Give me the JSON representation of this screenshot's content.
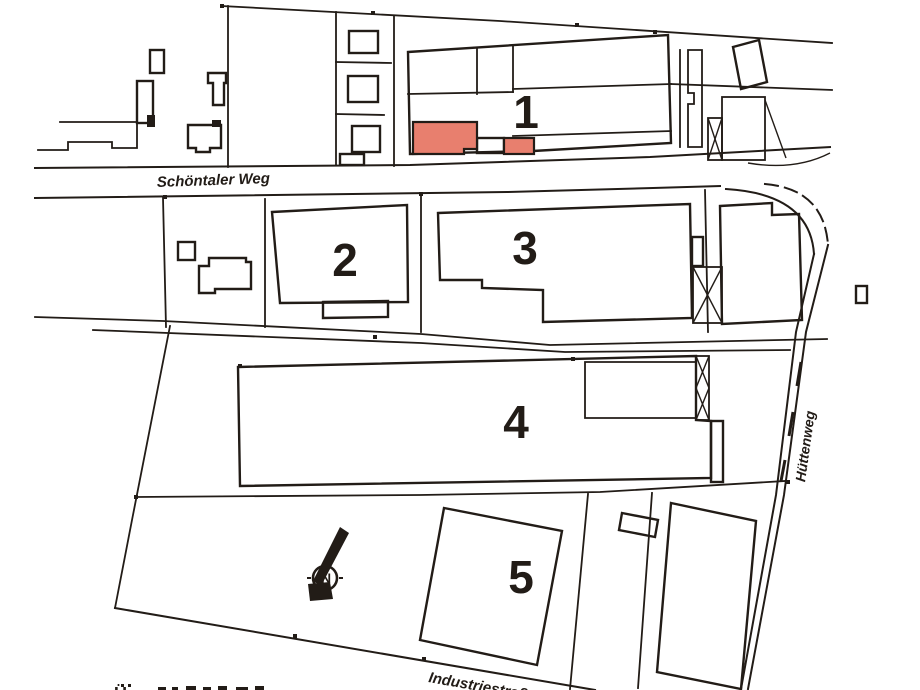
{
  "plan": {
    "streets": {
      "schoentaler_weg": "Schöntaler Weg",
      "huettenweg": "Hüttenweg",
      "industriestrasse": "Industriestraße"
    },
    "buildings": {
      "b1": "1",
      "b2": "2",
      "b3": "3",
      "b4": "4",
      "b5": "5"
    },
    "compass_north": "N",
    "cut_off_caption_fragment": "Ü",
    "colors": {
      "highlight_fill": "#e87f6e",
      "ink": "#221c17",
      "paper": "#ffffff"
    }
  }
}
